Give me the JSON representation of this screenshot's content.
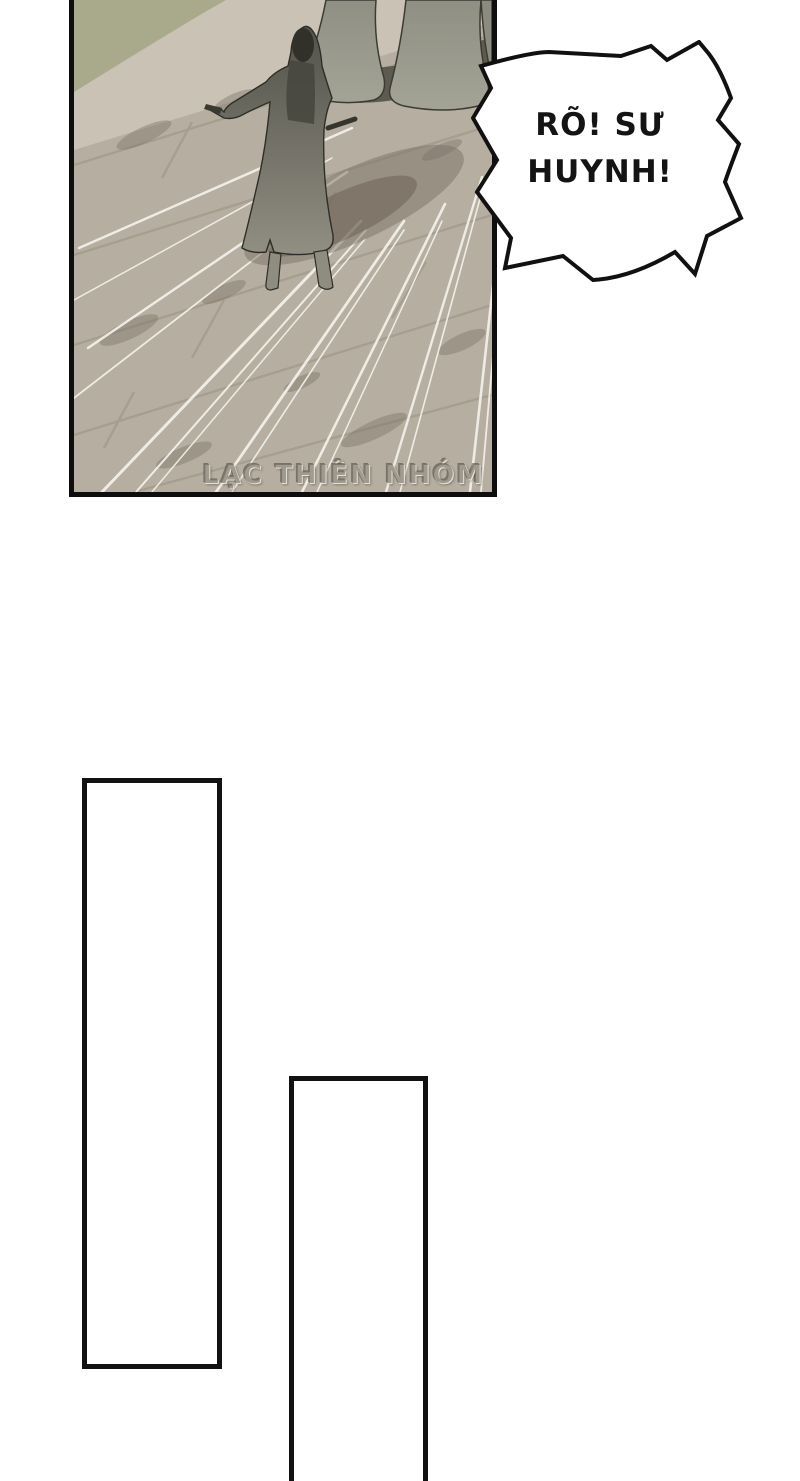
{
  "page": {
    "type": "comic-page",
    "background": "#ffffff"
  },
  "speech_bubble": {
    "line1": "RÕ! SƯ",
    "line2": "HUYNH!"
  },
  "panel": {
    "watermark": "LẠC THIÊN NHÓM"
  },
  "colors": {
    "panel_border": "#0e0e0e",
    "stone": "#b6aea1",
    "stone_light": "#ccc5b8",
    "grass": "#a6aa88",
    "robe": "#9c9c90",
    "figure_dark": "#55554d",
    "shadow": "#7a7265",
    "speed_line": "#f4f1ea",
    "bubble_fill": "#ffffff",
    "bubble_stroke": "#111111"
  }
}
